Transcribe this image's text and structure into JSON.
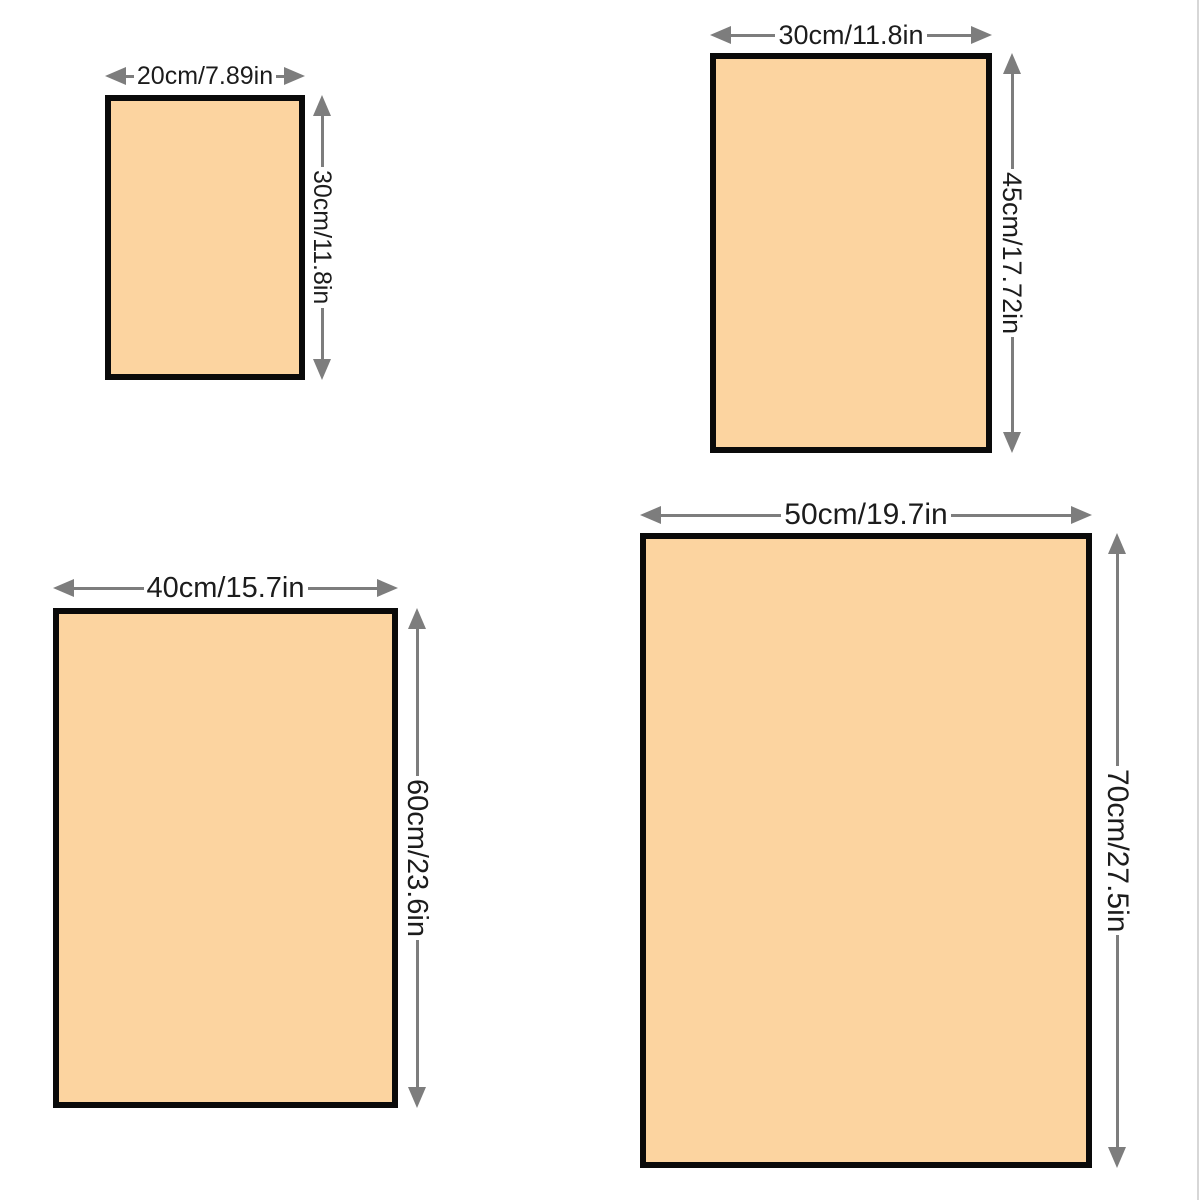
{
  "diagram": {
    "kind": "product-size-chart",
    "background": "#ffffff"
  },
  "colors": {
    "fill": "#FCD4A0",
    "border": "#0a0a0a",
    "arrow": "#7d7d7d",
    "text": "#1c1c1c",
    "edge": "#d7d7d7"
  },
  "sizes": [
    {
      "id": "20x30",
      "width_label": "20cm/7.89in",
      "height_label": "30cm/11.8in"
    },
    {
      "id": "30x45",
      "width_label": "30cm/11.8in",
      "height_label": "45cm/17.72in"
    },
    {
      "id": "40x60",
      "width_label": "40cm/15.7in",
      "height_label": "60cm/23.6in"
    },
    {
      "id": "50x70",
      "width_label": "50cm/19.7in",
      "height_label": "70cm/27.5in"
    }
  ]
}
